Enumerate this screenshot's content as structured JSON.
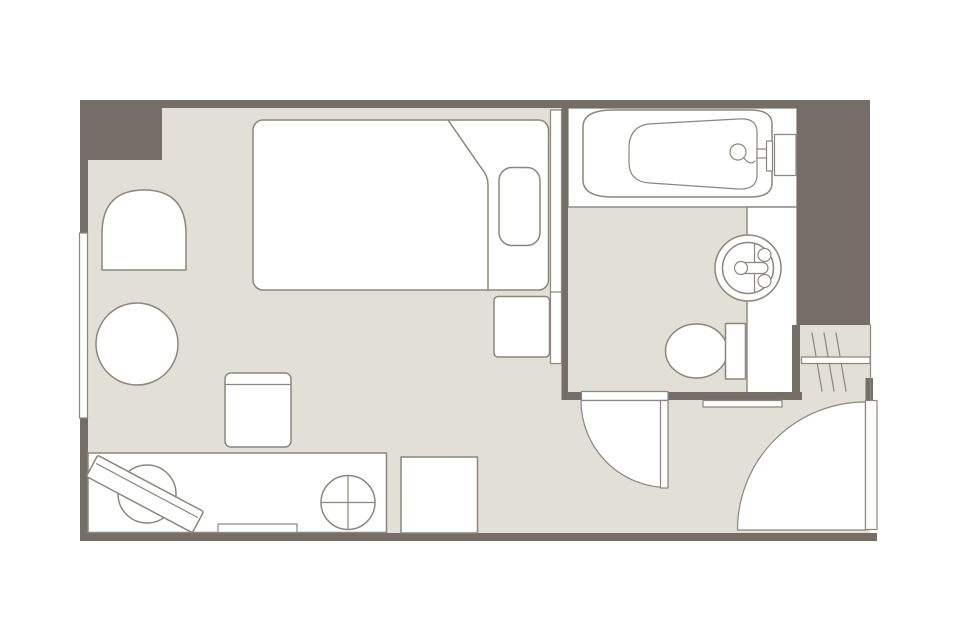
{
  "palette": {
    "background": "#ffffff",
    "floor": "#e2dfd6",
    "wall": "#756e67",
    "outline": "#8c867d",
    "fixture": "#ffffff"
  },
  "plan": {
    "type": "hotel-single-room-floor-plan",
    "rooms": [
      {
        "name": "bedroom"
      },
      {
        "name": "bathroom"
      },
      {
        "name": "entry-corridor"
      },
      {
        "name": "closet"
      }
    ],
    "furniture": [
      "bed",
      "folded-duvet",
      "pillow",
      "nightstand",
      "armchair",
      "round-table",
      "desk-chair",
      "desk",
      "tv-on-swivel",
      "keyboard-tray",
      "round-stool",
      "luggage-rack",
      "window",
      "bathtub",
      "bath-faucet-panel",
      "vanity-counter",
      "washbasin",
      "toilet",
      "hanger-rail",
      "hangers",
      "bathroom-door",
      "entrance-door",
      "door-threshold"
    ]
  }
}
